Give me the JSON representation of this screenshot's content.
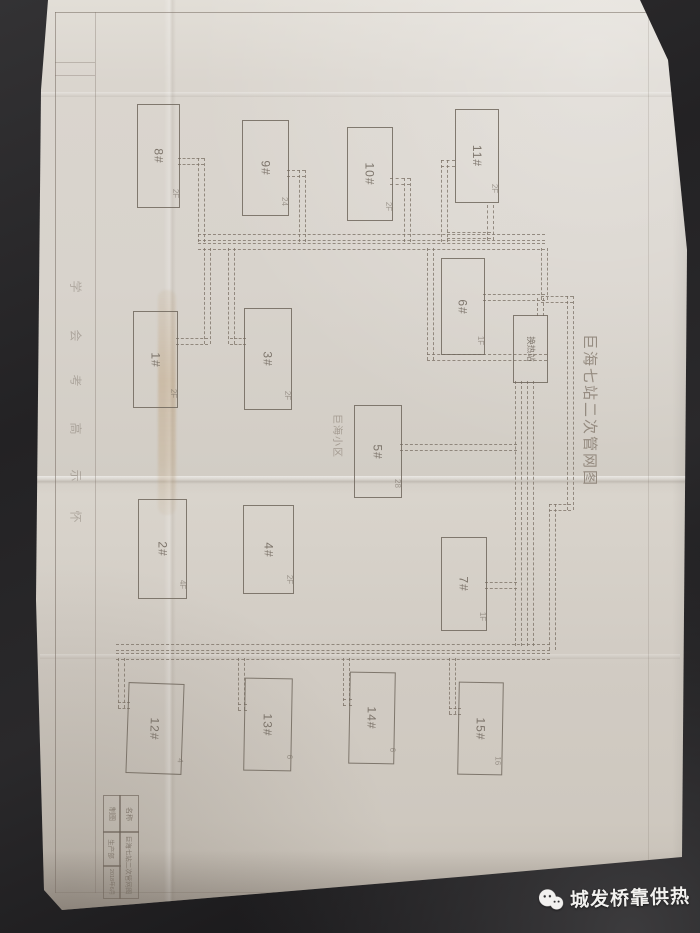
{
  "scene": {
    "watermark_text": "城发桥靠供热"
  },
  "drawing": {
    "title": "巨海七站二次管网图",
    "area_label": "巨海小区",
    "buildings": [
      {
        "label": "8#",
        "sub": "2F",
        "x": 137,
        "y": 104,
        "w": 41,
        "h": 102,
        "rot": 0
      },
      {
        "label": "9#",
        "sub": "24",
        "x": 242,
        "y": 120,
        "w": 45,
        "h": 94,
        "rot": 0
      },
      {
        "label": "10#",
        "sub": "2F",
        "x": 347,
        "y": 127,
        "w": 44,
        "h": 92,
        "rot": 0
      },
      {
        "label": "11#",
        "sub": "2F",
        "x": 455,
        "y": 109,
        "w": 42,
        "h": 92,
        "rot": 0
      },
      {
        "label": "1#",
        "sub": "2F",
        "x": 133,
        "y": 311,
        "w": 43,
        "h": 95,
        "rot": 0
      },
      {
        "label": "3#",
        "sub": "2F",
        "x": 244,
        "y": 308,
        "w": 46,
        "h": 100,
        "rot": 0
      },
      {
        "label": "6#",
        "sub": "1F",
        "x": 441,
        "y": 258,
        "w": 42,
        "h": 95,
        "rot": 0
      },
      {
        "label": "换热站",
        "sub": "",
        "x": 513,
        "y": 315,
        "w": 33,
        "h": 66,
        "rot": 0,
        "small": true
      },
      {
        "label": "5#",
        "sub": "28",
        "x": 354,
        "y": 405,
        "w": 46,
        "h": 91,
        "rot": 0
      },
      {
        "label": "2#",
        "sub": "4F",
        "x": 138,
        "y": 499,
        "w": 47,
        "h": 98,
        "rot": 0
      },
      {
        "label": "4#",
        "sub": "2F",
        "x": 243,
        "y": 505,
        "w": 49,
        "h": 87,
        "rot": 0
      },
      {
        "label": "7#",
        "sub": "1F",
        "x": 441,
        "y": 537,
        "w": 44,
        "h": 92,
        "rot": 0
      },
      {
        "label": "12#",
        "sub": "4",
        "x": 127,
        "y": 683,
        "w": 54,
        "h": 89,
        "rot": 2
      },
      {
        "label": "13#",
        "sub": "6",
        "x": 244,
        "y": 678,
        "w": 46,
        "h": 91,
        "rot": 1
      },
      {
        "label": "14#",
        "sub": "6",
        "x": 349,
        "y": 672,
        "w": 44,
        "h": 90,
        "rot": 1
      },
      {
        "label": "15#",
        "sub": "16",
        "x": 458,
        "y": 682,
        "w": 43,
        "h": 91,
        "rot": 1
      }
    ],
    "pipes": [
      {
        "o": "h",
        "x": 178,
        "y": 158,
        "l": 26
      },
      {
        "o": "v",
        "x": 198,
        "y": 158,
        "l": 84
      },
      {
        "o": "h",
        "x": 287,
        "y": 170,
        "l": 18
      },
      {
        "o": "v",
        "x": 299,
        "y": 170,
        "l": 72
      },
      {
        "o": "h",
        "x": 390,
        "y": 178,
        "l": 20
      },
      {
        "o": "v",
        "x": 404,
        "y": 178,
        "l": 64
      },
      {
        "o": "h",
        "x": 441,
        "y": 160,
        "l": 14
      },
      {
        "o": "v",
        "x": 441,
        "y": 160,
        "l": 82
      },
      {
        "o": "v",
        "x": 487,
        "y": 205,
        "l": 35
      },
      {
        "o": "h",
        "x": 447,
        "y": 232,
        "l": 44
      },
      {
        "o": "h",
        "x": 198,
        "y": 234,
        "l": 347
      },
      {
        "o": "h",
        "x": 198,
        "y": 243,
        "l": 347
      },
      {
        "o": "v",
        "x": 204,
        "y": 248,
        "l": 96
      },
      {
        "o": "h",
        "x": 176,
        "y": 338,
        "l": 32
      },
      {
        "o": "v",
        "x": 228,
        "y": 248,
        "l": 96
      },
      {
        "o": "h",
        "x": 230,
        "y": 338,
        "l": 16
      },
      {
        "o": "v",
        "x": 541,
        "y": 248,
        "l": 52
      },
      {
        "o": "h",
        "x": 541,
        "y": 296,
        "l": 32
      },
      {
        "o": "v",
        "x": 567,
        "y": 296,
        "l": 214
      },
      {
        "o": "h",
        "x": 549,
        "y": 504,
        "l": 22
      },
      {
        "o": "v",
        "x": 549,
        "y": 504,
        "l": 146
      },
      {
        "o": "v",
        "x": 427,
        "y": 248,
        "l": 112
      },
      {
        "o": "h",
        "x": 427,
        "y": 354,
        "l": 120
      },
      {
        "o": "h",
        "x": 483,
        "y": 294,
        "l": 62
      },
      {
        "o": "v",
        "x": 537,
        "y": 298,
        "l": 18
      },
      {
        "o": "v",
        "x": 515,
        "y": 381,
        "l": 265
      },
      {
        "o": "v",
        "x": 527,
        "y": 381,
        "l": 265
      },
      {
        "o": "h",
        "x": 400,
        "y": 444,
        "l": 117
      },
      {
        "o": "h",
        "x": 485,
        "y": 582,
        "l": 32
      },
      {
        "o": "h",
        "x": 116,
        "y": 644,
        "l": 434
      },
      {
        "o": "h",
        "x": 116,
        "y": 653,
        "l": 434
      },
      {
        "o": "v",
        "x": 118,
        "y": 658,
        "l": 50
      },
      {
        "o": "h",
        "x": 118,
        "y": 702,
        "l": 12
      },
      {
        "o": "v",
        "x": 238,
        "y": 658,
        "l": 52
      },
      {
        "o": "h",
        "x": 238,
        "y": 704,
        "l": 9
      },
      {
        "o": "v",
        "x": 343,
        "y": 658,
        "l": 48
      },
      {
        "o": "h",
        "x": 343,
        "y": 699,
        "l": 9
      },
      {
        "o": "v",
        "x": 449,
        "y": 658,
        "l": 56
      },
      {
        "o": "h",
        "x": 449,
        "y": 708,
        "l": 12
      }
    ],
    "margin_notes": [
      {
        "ch": "学",
        "y": 278
      },
      {
        "ch": "会",
        "y": 327
      },
      {
        "ch": "考",
        "y": 372
      },
      {
        "ch": "高",
        "y": 420
      },
      {
        "ch": "示",
        "y": 467
      },
      {
        "ch": "怀",
        "y": 508
      }
    ],
    "title_block": {
      "cells": [
        {
          "text": "制图",
          "x": 103,
          "y": 795,
          "w": 16,
          "h": 36,
          "fs": 7
        },
        {
          "text": "名称",
          "x": 119,
          "y": 795,
          "w": 18,
          "h": 36,
          "fs": 7
        },
        {
          "text": "生产部",
          "x": 103,
          "y": 831,
          "w": 16,
          "h": 34,
          "fs": 6.5
        },
        {
          "text": "2018年6月",
          "x": 103,
          "y": 865,
          "w": 16,
          "h": 32,
          "fs": 5.5
        },
        {
          "text": "巨海七站二次管网图",
          "x": 119,
          "y": 831,
          "w": 18,
          "h": 66,
          "fs": 6.5
        }
      ]
    }
  }
}
